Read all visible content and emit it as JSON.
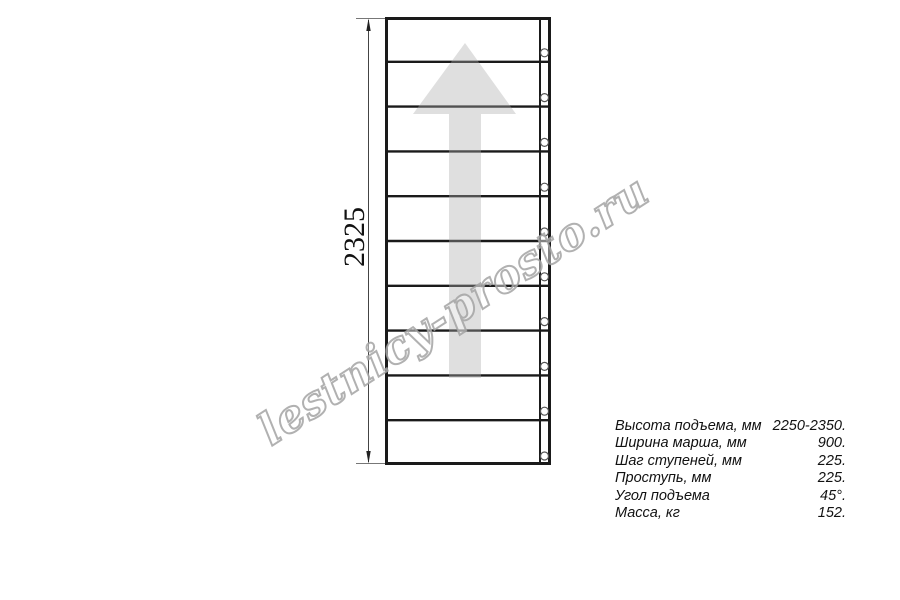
{
  "watermark": {
    "text": "lestnicy-prosto.ru",
    "outline_color": "#a3a3a3"
  },
  "drawing": {
    "dimension_label": "2325",
    "tread_count": 10,
    "bolt_count": 10,
    "arrow_direction": "up",
    "line_color": "#1a1a1a",
    "thin_line_color": "#555555",
    "arrow_fill": "rgba(170,170,170,0.38)"
  },
  "specs": {
    "rows": [
      {
        "label": "Высота подъема, мм",
        "value": "2250-2350."
      },
      {
        "label": "Ширина марша, мм",
        "value": "900."
      },
      {
        "label": "Шаг ступеней, мм",
        "value": "225."
      },
      {
        "label": "Проступь, мм",
        "value": "225."
      },
      {
        "label": "Угол подъема",
        "value": "45°."
      },
      {
        "label": "Масса, кг",
        "value": "152."
      }
    ]
  }
}
